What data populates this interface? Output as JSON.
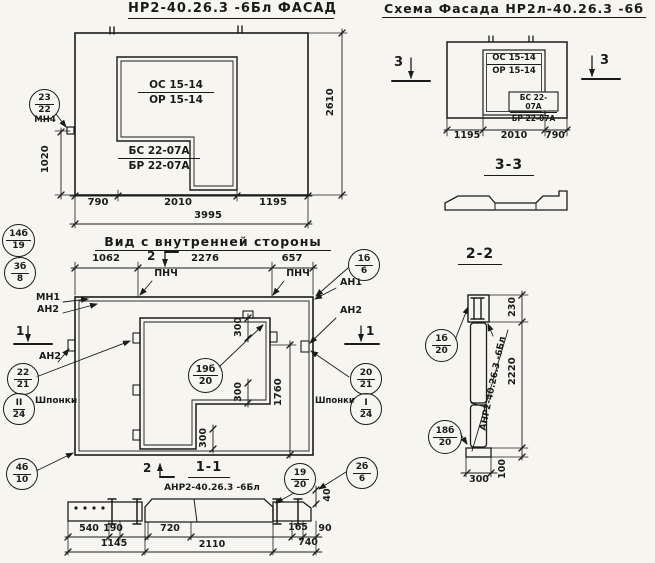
{
  "facade": {
    "title": "НР2-40.26.3 -6Бл ФАСАД",
    "opening_top": "ОС 15-14",
    "opening_bottom": "ОР 15-14",
    "sill_top": "БС 22-07А",
    "sill_bottom": "БР 22-07А",
    "dim_height_right": "2610",
    "dim_height_left": "1020",
    "dims_bottom": [
      "790",
      "2010",
      "1195"
    ],
    "dim_total": "3995",
    "callout": {
      "top": "23",
      "bottom": "22"
    },
    "callout_label": "МН4"
  },
  "schema": {
    "title": "Схема Фасада  НР2л-40.26.3 -6б",
    "opening_top": "ОС 15-14",
    "opening_bottom": "ОР 15-14",
    "sill_top": "БС 22-07А",
    "sill_bottom": "БР 22-07А",
    "dims_bottom": [
      "1195",
      "2010",
      "790"
    ],
    "marker_left": "3",
    "marker_right": "3"
  },
  "section33": {
    "title": "3-3"
  },
  "inner": {
    "title": "Вид с внутренней стороны",
    "dims_top": [
      "1062",
      "2276",
      "657"
    ],
    "marker_top": "2",
    "marker_left": "1",
    "marker_right": "1",
    "marker_bottom": "2",
    "pnch": "ПНЧ",
    "mn1": "МН1",
    "an1": "АН1",
    "an2": "АН2",
    "shponki": "Шпонки",
    "dim_300": "300",
    "dim_1760": "1760",
    "dim_40": "40",
    "callouts": {
      "tl": {
        "top": "14б",
        "bottom": "19"
      },
      "l2": {
        "top": "3б",
        "bottom": "8"
      },
      "r1": {
        "top": "1б",
        "bottom": "6"
      },
      "lm": {
        "top": "22",
        "bottom": "21"
      },
      "lk": {
        "top": "II",
        "bottom": "24"
      },
      "rm": {
        "top": "20",
        "bottom": "21"
      },
      "rk": {
        "top": "I",
        "bottom": "24"
      },
      "center": {
        "top": "19б",
        "bottom": "20"
      },
      "bl": {
        "top": "4б",
        "bottom": "10"
      },
      "br": {
        "top": "2б",
        "bottom": "6"
      }
    }
  },
  "section11": {
    "title": "1-1",
    "label": "АНР2-40.26.3  -6Бл",
    "dims_row1": [
      "540",
      "190",
      "720",
      "165",
      "90"
    ],
    "dims_row2": [
      "1145",
      "2110",
      "740"
    ],
    "callout": {
      "top": "19",
      "bottom": "20"
    }
  },
  "section22": {
    "title": "2-2",
    "label": "АНР2-40.26.3  -6Бл",
    "dim_top": "230",
    "dim_total": "2220",
    "dim_bottom": "100",
    "dim_width": "300",
    "callout_top": {
      "top": "1б",
      "bottom": "20"
    },
    "callout_bottom": {
      "top": "18б",
      "bottom": "20"
    }
  }
}
